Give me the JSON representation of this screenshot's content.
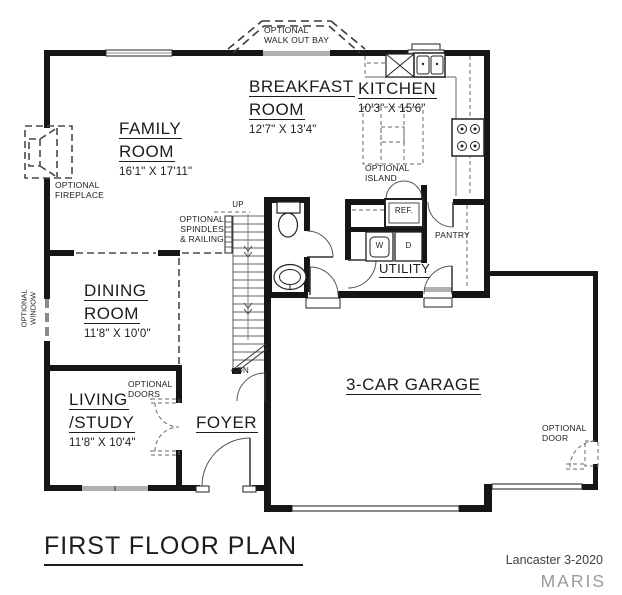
{
  "plan": {
    "title": "FIRST FLOOR PLAN",
    "credit": "Lancaster 3-2020",
    "watermark": "MARIS"
  },
  "rooms": {
    "family": {
      "line1": "FAMILY",
      "line2": "ROOM",
      "dims": "16'1\" X 17'11\""
    },
    "breakfast": {
      "line1": "BREAKFAST",
      "line2": "ROOM",
      "dims": "12'7\" X 13'4\""
    },
    "kitchen": {
      "line1": "KITCHEN",
      "dims": "10'3\" X 15'6\""
    },
    "dining": {
      "line1": "DINING",
      "line2": "ROOM",
      "dims": "11'8\" X 10'0\""
    },
    "living": {
      "line1": "LIVING",
      "line2": "/STUDY",
      "dims": "11'8\" X 10'4\""
    },
    "foyer": {
      "line1": "FOYER"
    },
    "utility": {
      "line1": "UTILITY"
    },
    "garage": {
      "line1": "3-CAR GARAGE"
    }
  },
  "labels": {
    "walkout_1": "OPTIONAL",
    "walkout_2": "WALK OUT BAY",
    "fireplace_1": "OPTIONAL",
    "fireplace_2": "FIREPLACE",
    "spindles_1": "OPTIONAL",
    "spindles_2": "SPINDLES",
    "spindles_3": "& RAILING",
    "window_1": "OPTIONAL",
    "window_2": "WINDOW",
    "doors_1": "OPTIONAL",
    "doors_2": "DOORS",
    "island_1": "OPTIONAL",
    "island_2": "ISLAND",
    "door_1": "OPTIONAL",
    "door_2": "DOOR",
    "pantry": "PANTRY",
    "ref": "REF.",
    "washer": "W",
    "dryer": "D",
    "up": "UP",
    "dn": "DN"
  },
  "colors": {
    "wall": "#161616",
    "gray_fill": "#b0b0b0",
    "dashed": "#4a4a4a",
    "text": "#1c1c1c",
    "credit": "#3f3f3f",
    "watermark": "#9b9b9b"
  }
}
